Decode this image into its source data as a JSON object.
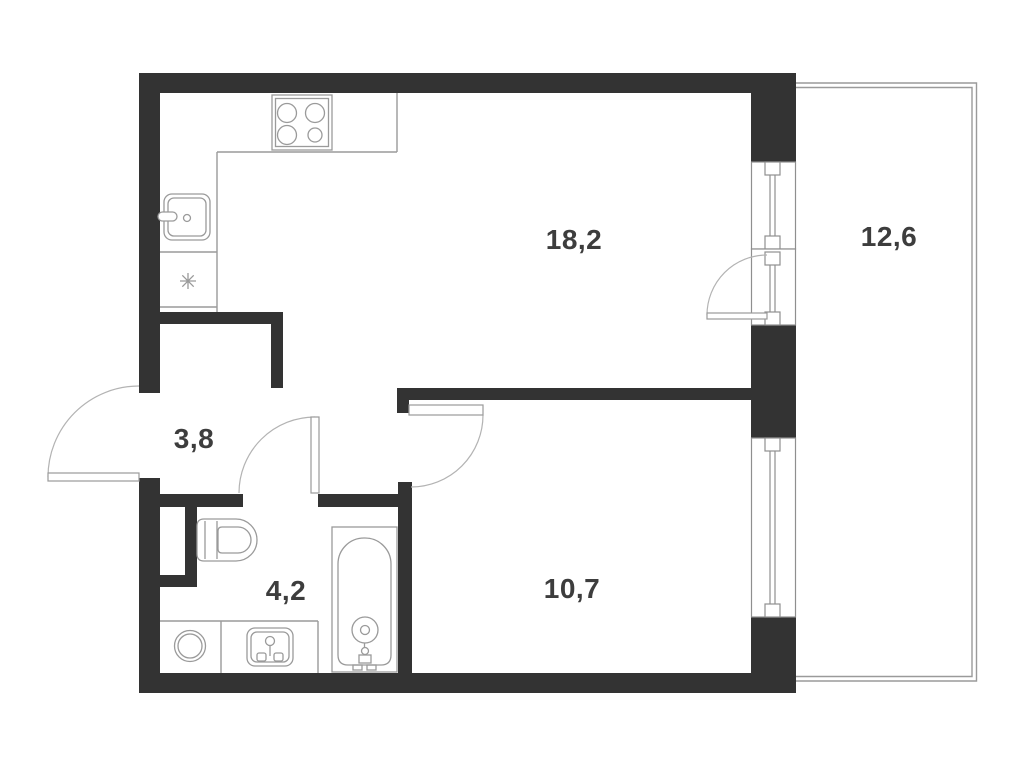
{
  "plan": {
    "rooms": [
      {
        "id": "kitchen-living",
        "area": "18,2"
      },
      {
        "id": "balcony",
        "area": "12,6"
      },
      {
        "id": "hallway",
        "area": "3,8"
      },
      {
        "id": "bathroom",
        "area": "4,2"
      },
      {
        "id": "bedroom",
        "area": "10,7"
      }
    ],
    "fixtures": [
      "stove-icon",
      "kitchen-sink-icon",
      "fridge-asterisk-icon",
      "toilet-icon",
      "washing-machine-icon",
      "bathroom-sink-icon",
      "bathtub-icon",
      "window-icon",
      "balcony-door-icon",
      "entry-door-icon",
      "bathroom-door-icon",
      "bedroom-door-icon"
    ],
    "colors": {
      "wall": "#333333",
      "line": "#9a9a9a",
      "label": "#3d3d3d",
      "background": "#ffffff"
    }
  }
}
